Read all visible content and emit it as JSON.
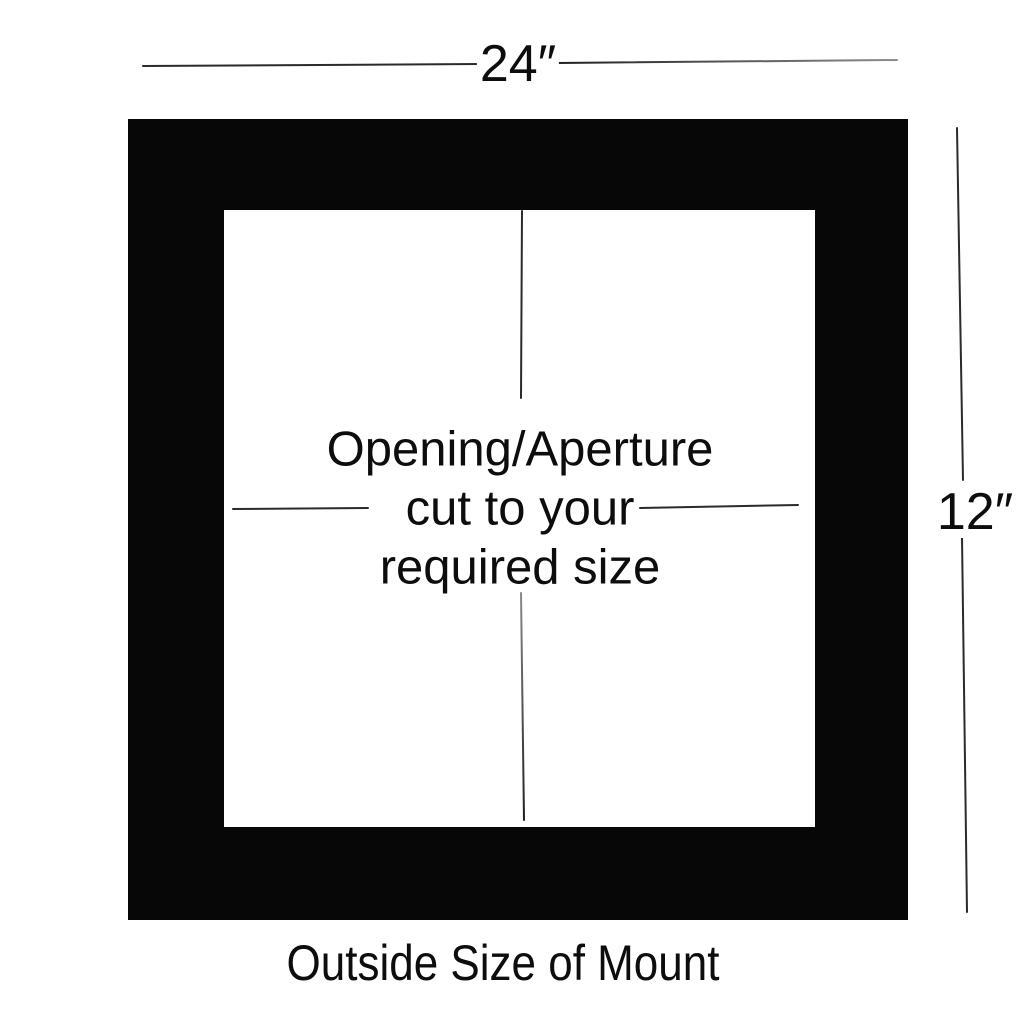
{
  "labels": {
    "width": "24″",
    "height": "12″",
    "bottom": "Outside Size of Mount"
  },
  "aperture_text": {
    "line1": "Opening/Aperture",
    "line2": "cut to your",
    "line3": "required size"
  },
  "colors": {
    "bg": "#ffffff",
    "mount": "#070707",
    "line": "#2b2b2b",
    "text": "#0d0d0d"
  }
}
